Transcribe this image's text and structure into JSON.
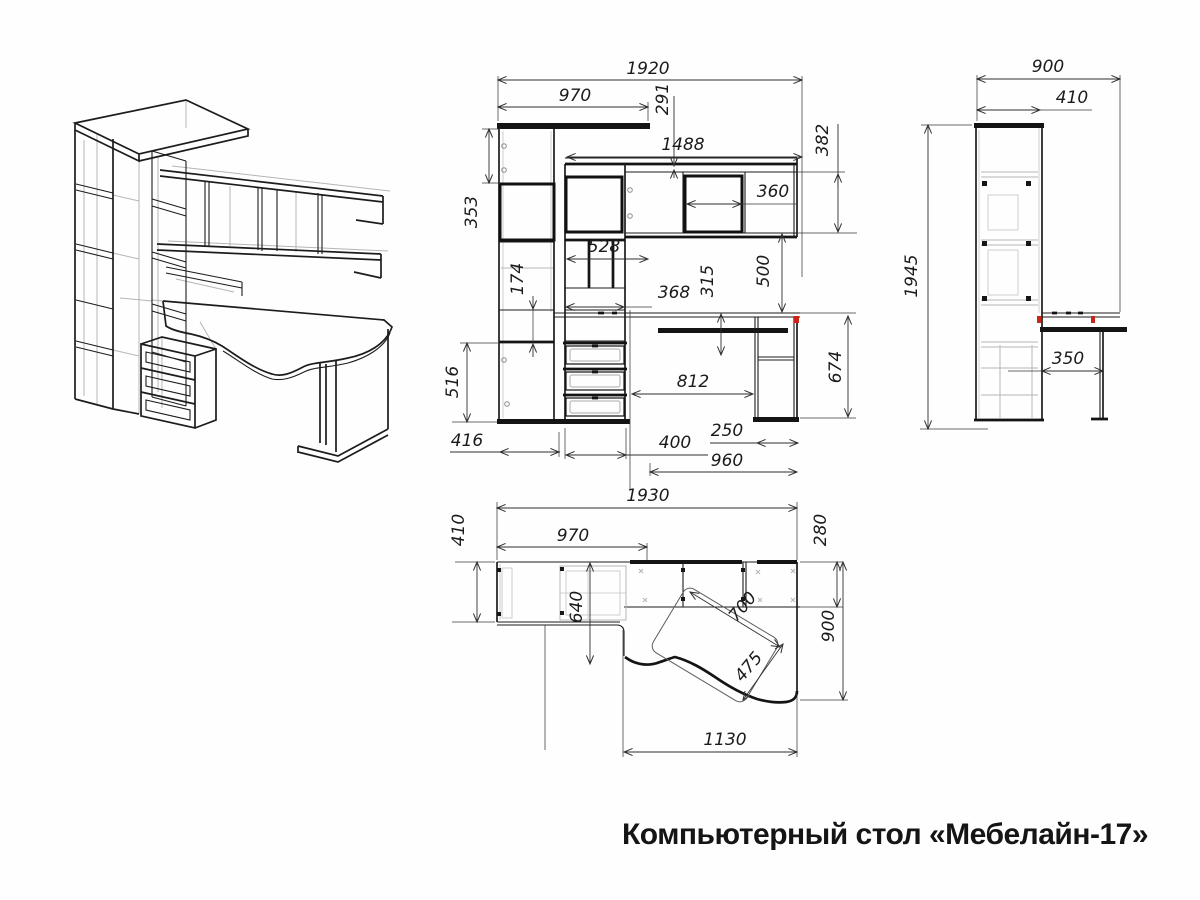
{
  "title": "Компьютерный стол «Мебелайн-17»",
  "palette": {
    "line": "#1c1c1c",
    "hidden_line": "#b5b5b5",
    "dimension_line": "#2f2f2f",
    "red_marker": "#c9251a",
    "background": "#ffffff"
  },
  "views": {
    "front": {
      "dims": {
        "total_width": "1920",
        "top_shelf_width": "970",
        "canopy_drop": "291",
        "shelves_span": "1488",
        "shelf_unit_height": "382",
        "shelf_cell_width": "360",
        "top_section_height": "353",
        "cells_width": "528",
        "niche_height": "174",
        "tower_width": "368",
        "desk_to_tray": "315",
        "shelf_to_desk": "500",
        "door_height": "516",
        "knee_space_width": "812",
        "desk_height": "674",
        "column_width": "416",
        "drawer_unit_width": "400",
        "leg_width": "250",
        "desk_span": "960"
      }
    },
    "side": {
      "dims": {
        "total_depth": "900",
        "cabinet_depth": "410",
        "total_height": "1945",
        "desk_overhang": "350"
      }
    },
    "top": {
      "dims": {
        "total_width": "1930",
        "strip_depth": "410",
        "top_shelf_width": "970",
        "shelf_strip_depth": "280",
        "tower_depth": "640",
        "tray_length": "700",
        "tray_width": "475",
        "desk_depth": "900",
        "desk_width": "1130"
      }
    }
  }
}
